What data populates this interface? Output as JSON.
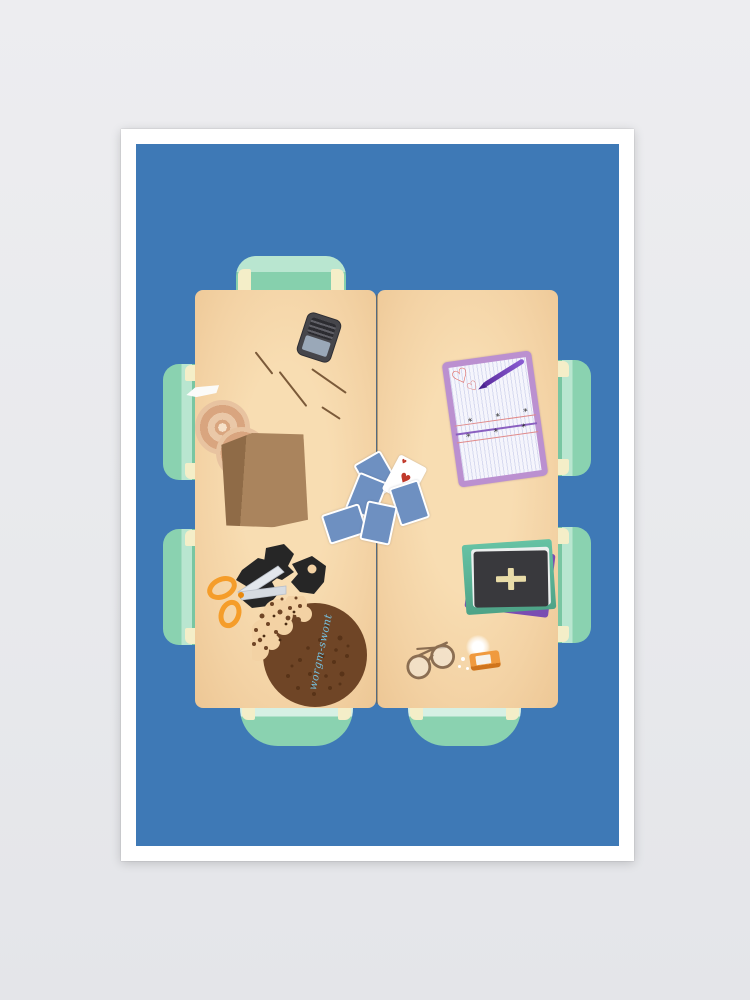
{
  "meta": {
    "kind": "flat vector illustration poster",
    "subject": "top-down view of two tables pushed together with seven mint chairs and scattered objects"
  },
  "palette": {
    "page_background": "#e9eaed",
    "poster_frame": "#ffffff",
    "art_background": "#3e79b6",
    "table_wood": "#f3d2a4",
    "chair_mint": "#8ad2b0",
    "chair_seat_light": "#b9e6d0",
    "chair_post_cream": "#f4eec8"
  },
  "table": {
    "halves": 2,
    "chair_count": 7
  },
  "objects": {
    "phone": {
      "body_color": "#46464b",
      "screen_color": "#9aa8b8"
    },
    "knife": {
      "color": "#fbfbf9"
    },
    "sticks": {
      "count": 4,
      "color": "#7b5a39"
    },
    "donuts": {
      "count": 2,
      "color": "#d9a57f"
    },
    "paper_bag": {
      "color": "#aa845d"
    },
    "cards": {
      "face_down_count": 5,
      "back_color": "#6e90c1",
      "face_up": "ace of hearts",
      "suit_symbol": "♥"
    },
    "notepad": {
      "frame_color": "#bb90d0",
      "paper_color": "#f5f5fc",
      "heart_symbol": "♡",
      "pen_color": "#7a3fc9",
      "mark": "*",
      "rule_colors": [
        "#e08a8a",
        "#8a5fc0"
      ]
    },
    "books": {
      "count": 4,
      "top_book": "black book with cream cross",
      "colors": [
        "#7a4db2",
        "#58b193",
        "#ecefee",
        "#39393d"
      ]
    },
    "scissors": {
      "handle_color": "#f59d2a",
      "blade_color": "#e3e7ec"
    },
    "paper_scraps": {
      "color": "#262626"
    },
    "cookie": {
      "color": "#6f4526",
      "bite": "upper-left with crumbs",
      "icing_text": "worgm-swont",
      "icing_color": "#76c0de"
    },
    "glasses": {
      "frame_color": "#8b6e52"
    },
    "lighter": {
      "body_color": "#f09a3e",
      "glow": "#ffffff"
    }
  }
}
